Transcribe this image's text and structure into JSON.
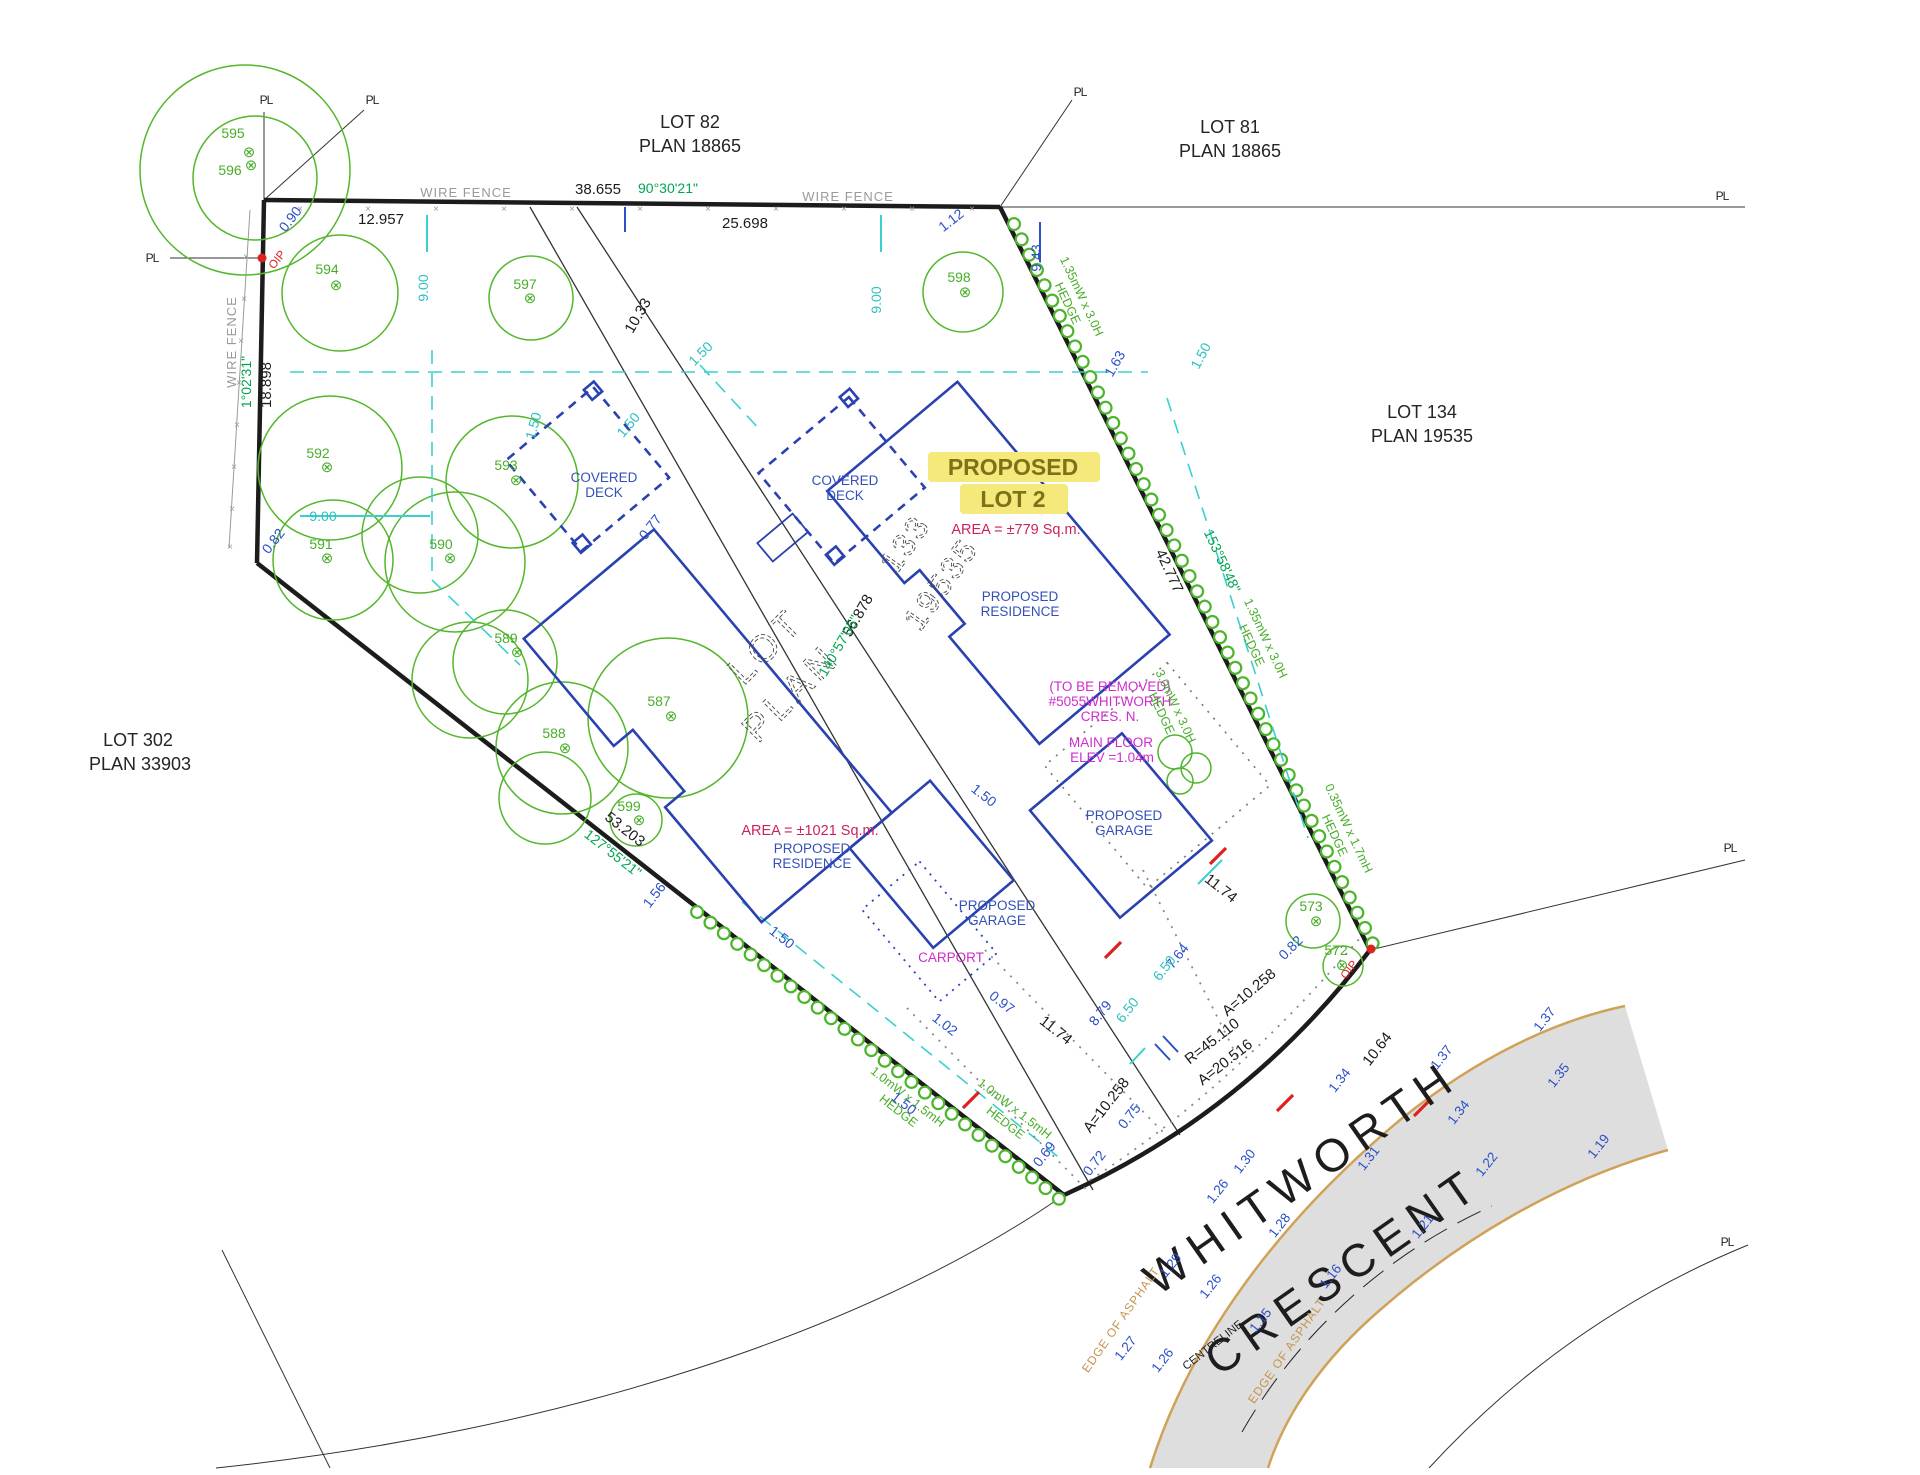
{
  "drawing": "residential lot plan survey",
  "colors": {
    "boundary": "#1c1c1c",
    "building": "#2a41b0",
    "dim_blue": "#2b50c8",
    "dim_cyan": "#2fc0c0",
    "tree_green": "#55b62e",
    "angle_green": "#00a550",
    "magenta": "#cf2bcf",
    "crimson": "#cc2060",
    "highlight_yellow": "#f6e97c",
    "road_fill": "#dedede",
    "asphalt_edge": "#cfa258",
    "wire_fence_gray": "#9a9a9a",
    "oip_red": "#dd2222"
  },
  "lots": {
    "lot82": "LOT 82",
    "plan18865": "PLAN 18865",
    "lot81": "LOT 81",
    "lot134": "LOT 134",
    "plan19535": "PLAN 19535",
    "lot302": "LOT 302",
    "plan33903": "PLAN 33903"
  },
  "proposed": {
    "l1": "PROPOSED",
    "l2": "LOT 2",
    "area_lot2": "AREA = ±779 Sq.m.",
    "area_lot1": "AREA = ±1021 Sq.m."
  },
  "buildings": {
    "covered": "COVERED",
    "deck": "DECK",
    "proposed": "PROPOSED",
    "residence": "RESIDENCE",
    "garage": "GARAGE",
    "carport": "CARPORT",
    "tbr1": "(TO BE REMOVED)",
    "tbr2": "#5055WHITWORTH",
    "tbr3": "CRES. N.",
    "mf1": "MAIN FLOOR",
    "mf2": "ELEV =1.04m"
  },
  "outline_text": {
    "lot": "LOT",
    "plan": "PLAN",
    "old1": "133",
    "old2": "19535"
  },
  "dims": {
    "d12957": "12.957",
    "d38655": "38.655",
    "d25698": "25.698",
    "d18898": "18.898",
    "d1033": "10.33",
    "d56878": "56.878",
    "d53203": "53.203",
    "d42777": "42.777",
    "d1174": "11.74",
    "a10258": "A=10.258",
    "r45110": "R=45.110",
    "a20516": "A=20.516",
    "d1064": "10.64",
    "d090": "0.90",
    "d112": "1.12",
    "d943": "9.43",
    "d163": "1.63",
    "d082": "0.82",
    "d077": "0.77",
    "d150": "1.50",
    "d102": "1.02",
    "d097": "0.97",
    "d156": "1.56",
    "d069": "0.69",
    "d072": "0.72",
    "d075": "0.75",
    "d764": "7.64",
    "d879": "8.79",
    "d900": "9.00",
    "d650": "6.50"
  },
  "angles": {
    "a90": "90°30'21\"",
    "a1": "1°02'31\"",
    "a140": "140°57'05\"",
    "a127": "127°55'21\"",
    "a153": "153°58'48\""
  },
  "hedges": {
    "h135": "1.35mW x 3.0H",
    "h30": "3.0mW x 3.0H",
    "h035": "0.35mW x 1.7mH",
    "h10": "1.0mW x 1.5mH",
    "hedge": "HEDGE"
  },
  "fences": {
    "wire": "WIRE FENCE"
  },
  "road": {
    "name1": "WHITWORTH",
    "name2": "CRESCENT",
    "edge": "EDGE OF ASPHALT",
    "centreline": "CENTRELINE",
    "elevations": [
      "1.37",
      "1.37",
      "1.35",
      "1.34",
      "1.34",
      "1.31",
      "1.30",
      "1.26",
      "1.28",
      "1.29",
      "1.26",
      "1.27",
      "1.26",
      "1.22",
      "1.21",
      "1.19",
      "1.16",
      "1.15"
    ]
  },
  "markers": {
    "pl": "PL",
    "oip": "OIP"
  },
  "trees": {
    "sym": "⊗",
    "t572": "572",
    "t573": "573",
    "t587": "587",
    "t588": "588",
    "t589": "589",
    "t590": "590",
    "t591": "591",
    "t592": "592",
    "t593": "593",
    "t594": "594",
    "t595": "595",
    "t596": "596",
    "t597": "597",
    "t598": "598",
    "t599": "599"
  }
}
